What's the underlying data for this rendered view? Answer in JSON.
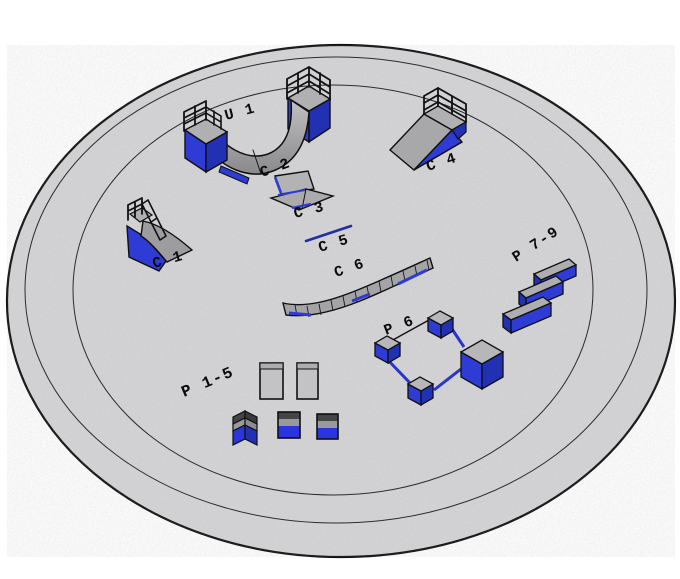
{
  "scene": {
    "background_color": "#ffffff",
    "floor_color": "#d6d6d8",
    "outline_color": "#101010",
    "ring_count": 3,
    "palette": {
      "blue_front": "#2e3bd5",
      "blue_side": "#2230b4",
      "blue_bright": "#2a35dd",
      "gray_top": "#b7b7b9",
      "gray_surface": "#a2a2a5",
      "dark_band": "#454547",
      "label_color": "#0a0a0a"
    }
  },
  "obstacles": [
    {
      "id": "u1",
      "label": "U 1",
      "kind": "mini-ramp-halfpipe-with-rails"
    },
    {
      "id": "c1",
      "label": "C 1",
      "kind": "quarter-pipe-with-rail"
    },
    {
      "id": "c2",
      "label": "C 2",
      "kind": "bank-ledge"
    },
    {
      "id": "c3",
      "label": "C 3",
      "kind": "bank-ledge"
    },
    {
      "id": "c4",
      "label": "C 4",
      "kind": "bank-ramp-with-rail"
    },
    {
      "id": "c5",
      "label": "C 5",
      "kind": "flat-rail"
    },
    {
      "id": "c6",
      "label": "C 6",
      "kind": "segmented-snake-ledge"
    },
    {
      "id": "p15",
      "label": "P 1-5",
      "kind": "pads-and-boxes"
    },
    {
      "id": "p6",
      "label": "P 6",
      "kind": "boxes-connected-by-rails"
    },
    {
      "id": "p79",
      "label": "P 7-9",
      "kind": "angled-grind-ledges"
    }
  ]
}
